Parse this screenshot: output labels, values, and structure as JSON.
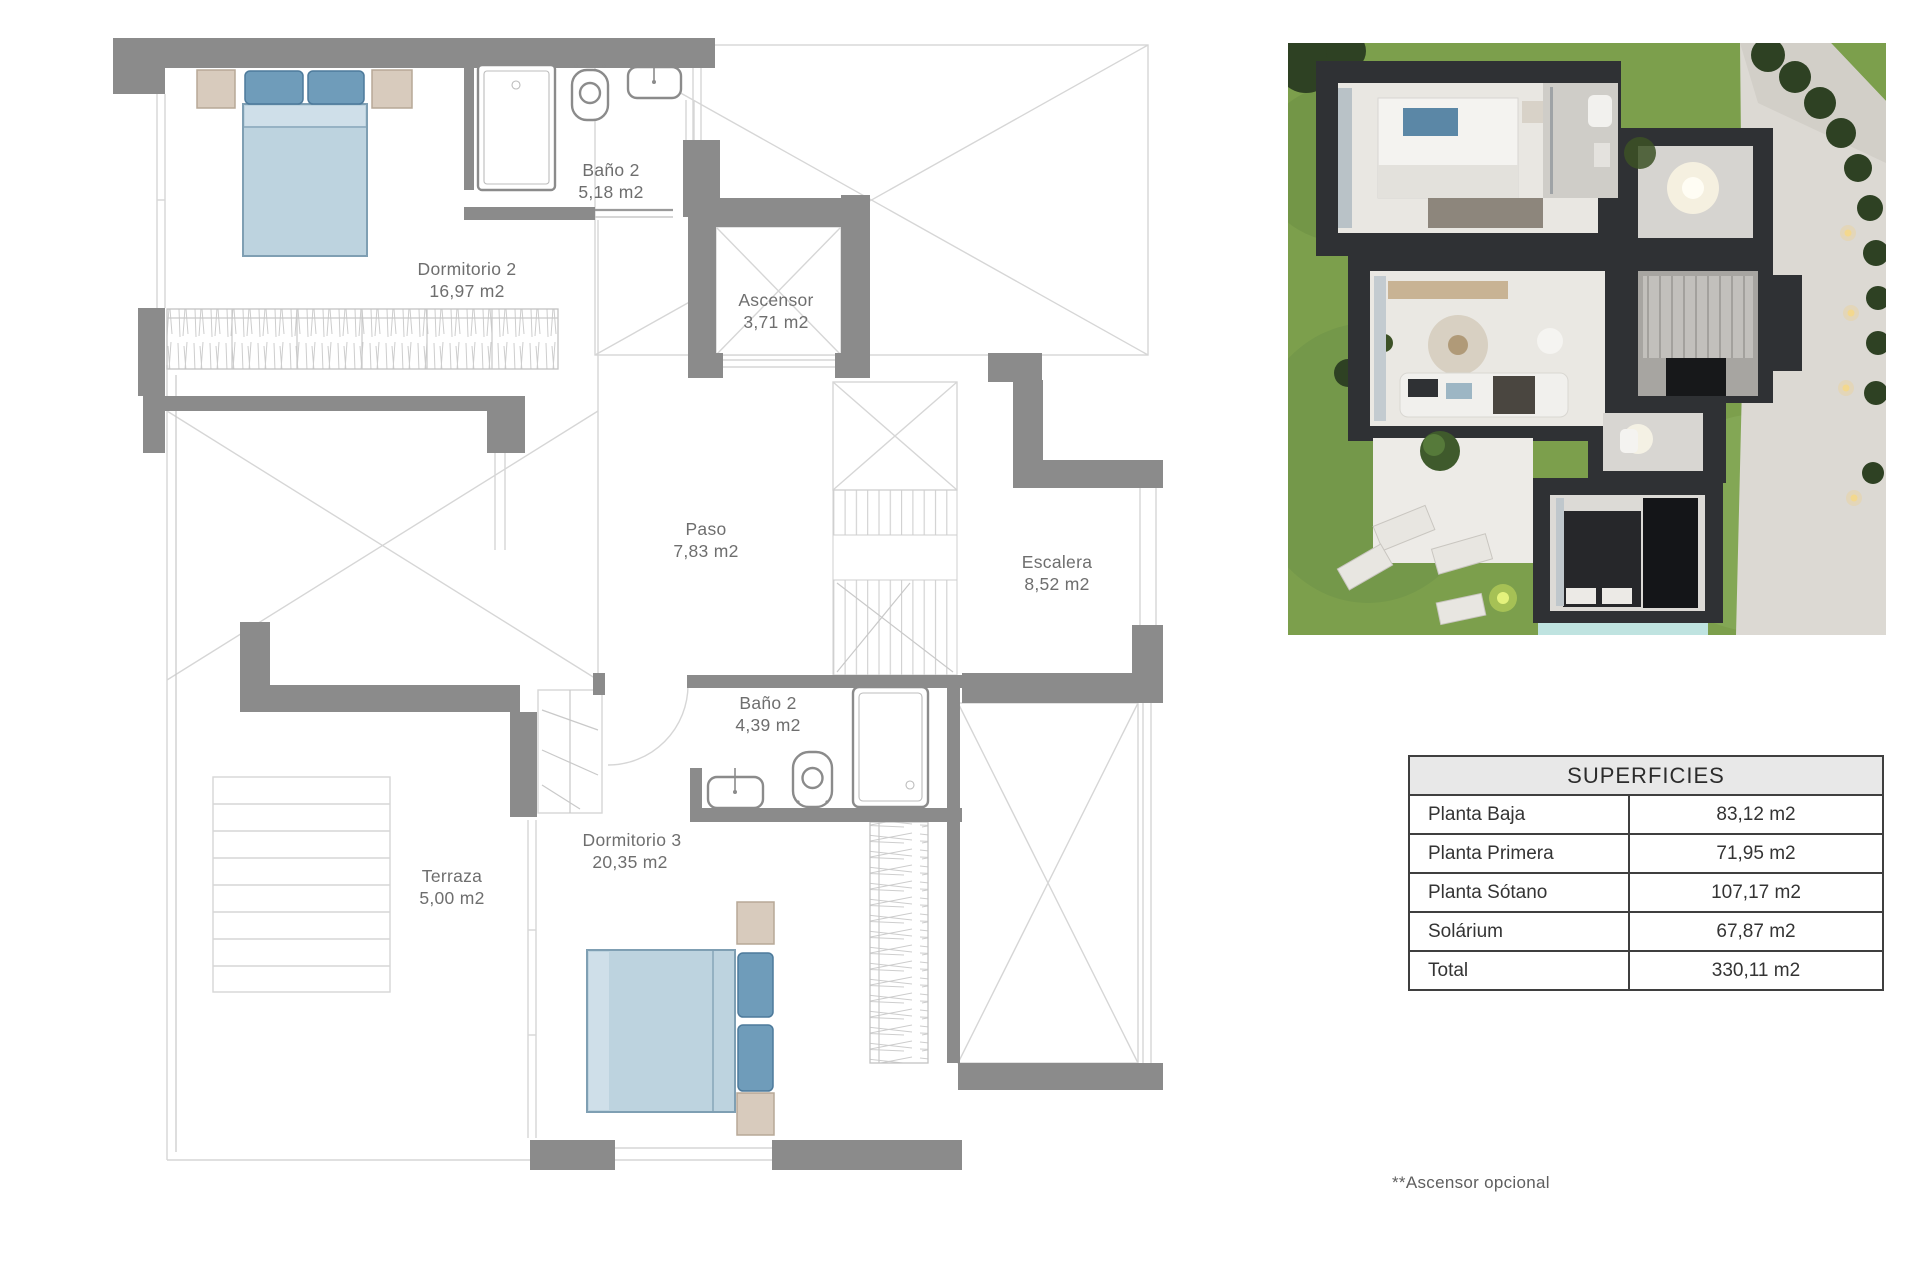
{
  "floor_plan": {
    "rooms": [
      {
        "name": "Dormitorio 2",
        "area": "16,97 m2"
      },
      {
        "name": "Baño 2",
        "area": "5,18 m2"
      },
      {
        "name": "Ascensor",
        "area": "3,71 m2"
      },
      {
        "name": "Paso",
        "area": "7,83 m2"
      },
      {
        "name": "Escalera",
        "area": "8,52 m2"
      },
      {
        "name": "Baño 2",
        "area": "4,39 m2"
      },
      {
        "name": "Dormitorio 3",
        "area": "20,35 m2"
      },
      {
        "name": "Terraza",
        "area": "5,00 m2"
      }
    ]
  },
  "surfaces_table": {
    "title": "SUPERFICIES",
    "rows": [
      {
        "label": "Planta Baja",
        "value": "83,12 m2"
      },
      {
        "label": "Planta Primera",
        "value": "71,95 m2"
      },
      {
        "label": "Planta Sótano",
        "value": "107,17 m2"
      },
      {
        "label": "Solárium",
        "value": "67,87 m2"
      },
      {
        "label": "Total",
        "value": "330,11 m2"
      }
    ]
  },
  "footnote": "**Ascensor opcional",
  "colors": {
    "wall_gray": "#8b8b8b",
    "thin_line": "#d6d6d6",
    "bed_blue": "#bdd3df",
    "pillow_blue": "#6f9cba",
    "furniture_tan": "#d8cbbd",
    "label_text": "#6e6e6e",
    "table_border": "#3f3f3f",
    "table_header_bg": "#e8e8e8",
    "render_grass": "#7c9f4c",
    "render_house": "#2f3134"
  }
}
